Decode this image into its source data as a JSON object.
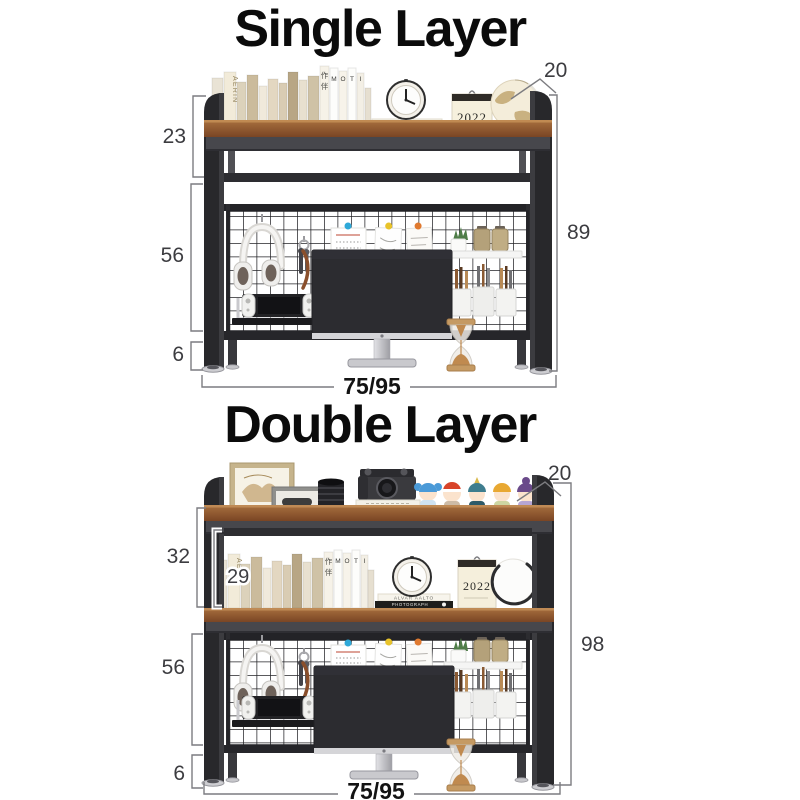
{
  "page": {
    "background": "#ffffff"
  },
  "sections": [
    {
      "title": "Single Layer",
      "dimensions": {
        "depth": "20",
        "shelf_height": "23",
        "mesh_height": "56",
        "feet_height": "6",
        "total_height": "89",
        "width": "75/95"
      }
    },
    {
      "title": "Double Layer",
      "dimensions": {
        "depth": "20",
        "top_section_height": "32",
        "inner_shelf_height": "29",
        "mesh_height": "56",
        "feet_height": "6",
        "total_height": "98",
        "width": "75/95"
      }
    }
  ],
  "decor": {
    "book_brand": "AERIN",
    "book_letters": "MOTI",
    "book_cjk": "作伴",
    "stacked_books_top": "ALVAR AALTO",
    "stacked_books_bottom": "PHOTOGRAPH",
    "calendar_year": "2022"
  },
  "colors": {
    "frame": "#28282b",
    "wood": "#8a5632",
    "mesh": "#232327",
    "pin_blue": "#2ea8d8",
    "pin_yellow": "#e8c32a",
    "pin_orange": "#e07a30"
  }
}
